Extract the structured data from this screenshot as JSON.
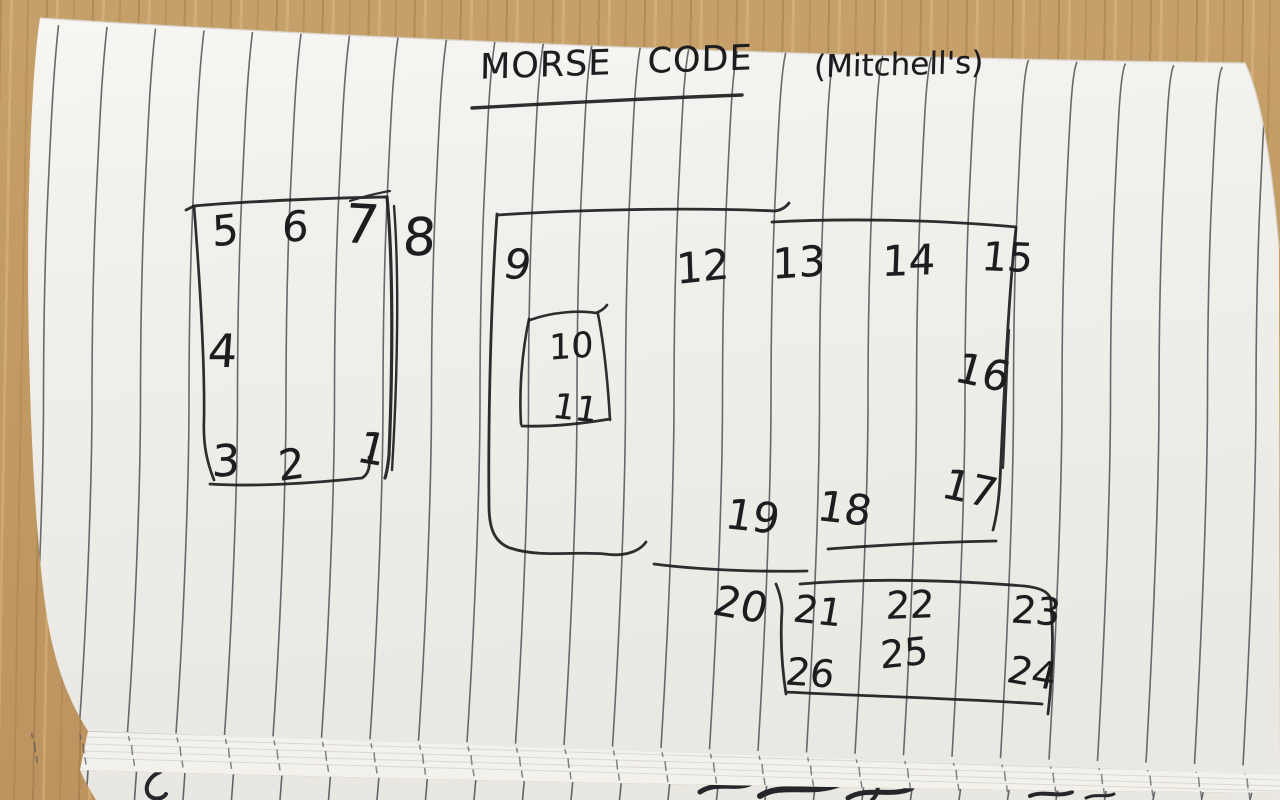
{
  "title": {
    "text": "MORSE CODE",
    "annotation": "(Mitchell's)"
  },
  "colors": {
    "ink": "#1d1d20",
    "rule_line": "#54555b",
    "paper": "#efeee9",
    "wood": "#c29a63"
  },
  "diagram": {
    "boxes": [
      {
        "id": "left-box",
        "numbers": [
          "5",
          "6",
          "7",
          "4",
          "3",
          "2",
          "1"
        ]
      },
      {
        "id": "outside-left-box",
        "numbers": [
          "8"
        ]
      },
      {
        "id": "large-box",
        "numbers": [
          "9",
          "12",
          "13",
          "14",
          "15",
          "16",
          "17",
          "18",
          "19"
        ]
      },
      {
        "id": "inner-box",
        "numbers": [
          "10",
          "11"
        ]
      },
      {
        "id": "outside-small-box",
        "numbers": [
          "20"
        ]
      },
      {
        "id": "small-box",
        "numbers": [
          "21",
          "22",
          "23",
          "26",
          "25",
          "24"
        ]
      }
    ],
    "numbers": [
      {
        "t": "5",
        "x": 212,
        "y": 210,
        "s": 42,
        "r": -6
      },
      {
        "t": "6",
        "x": 282,
        "y": 206,
        "s": 42,
        "r": -2
      },
      {
        "t": "7",
        "x": 344,
        "y": 198,
        "s": 54,
        "r": 3
      },
      {
        "t": "8",
        "x": 403,
        "y": 212,
        "s": 52,
        "r": 0
      },
      {
        "t": "4",
        "x": 208,
        "y": 328,
        "s": 46,
        "r": 0
      },
      {
        "t": "3",
        "x": 212,
        "y": 440,
        "s": 44,
        "r": -2
      },
      {
        "t": "2",
        "x": 278,
        "y": 444,
        "s": 42,
        "r": -8
      },
      {
        "t": "1",
        "x": 358,
        "y": 428,
        "s": 44,
        "r": 10
      },
      {
        "t": "9",
        "x": 504,
        "y": 244,
        "s": 42,
        "r": 8
      },
      {
        "t": "12",
        "x": 676,
        "y": 246,
        "s": 42,
        "r": -6
      },
      {
        "t": "13",
        "x": 772,
        "y": 242,
        "s": 42,
        "r": -4
      },
      {
        "t": "14",
        "x": 882,
        "y": 240,
        "s": 42,
        "r": -2
      },
      {
        "t": "15",
        "x": 982,
        "y": 238,
        "s": 40,
        "r": 2
      },
      {
        "t": "10",
        "x": 549,
        "y": 330,
        "s": 35,
        "r": -4
      },
      {
        "t": "11",
        "x": 553,
        "y": 392,
        "s": 35,
        "r": 6
      },
      {
        "t": "16",
        "x": 956,
        "y": 352,
        "s": 42,
        "r": 12
      },
      {
        "t": "17",
        "x": 943,
        "y": 468,
        "s": 42,
        "r": 12
      },
      {
        "t": "18",
        "x": 818,
        "y": 488,
        "s": 42,
        "r": 6
      },
      {
        "t": "19",
        "x": 726,
        "y": 496,
        "s": 42,
        "r": 6
      },
      {
        "t": "20",
        "x": 714,
        "y": 584,
        "s": 42,
        "r": 10
      },
      {
        "t": "21",
        "x": 794,
        "y": 592,
        "s": 38,
        "r": 6
      },
      {
        "t": "22",
        "x": 886,
        "y": 586,
        "s": 38,
        "r": -2
      },
      {
        "t": "23",
        "x": 1012,
        "y": 592,
        "s": 38,
        "r": 4
      },
      {
        "t": "26",
        "x": 786,
        "y": 654,
        "s": 38,
        "r": 4
      },
      {
        "t": "25",
        "x": 880,
        "y": 634,
        "s": 38,
        "r": -6
      },
      {
        "t": "24",
        "x": 1008,
        "y": 654,
        "s": 38,
        "r": 10
      }
    ]
  }
}
